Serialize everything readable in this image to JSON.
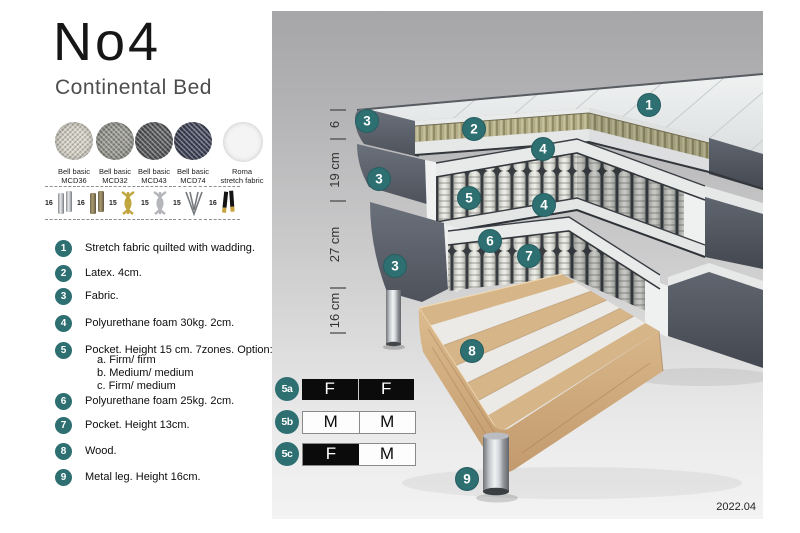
{
  "header": {
    "title": "No4",
    "subtitle": "Continental Bed"
  },
  "swatches": [
    {
      "line1": "Bell basic",
      "line2": "MCD36"
    },
    {
      "line1": "Bell basic",
      "line2": "MCD32"
    },
    {
      "line1": "Bell basic",
      "line2": "MCD43"
    },
    {
      "line1": "Bell basic",
      "line2": "MCD74"
    },
    {
      "line1": "Roma",
      "line2": "stretch fabric"
    }
  ],
  "leg_heights": [
    "16",
    "16",
    "15",
    "15",
    "15",
    "16"
  ],
  "legend": [
    {
      "num": "1",
      "text": "Stretch fabric quilted with wadding."
    },
    {
      "num": "2",
      "text": "Latex. 4cm."
    },
    {
      "num": "3",
      "text": "Fabric."
    },
    {
      "num": "4",
      "text": "Polyurethane foam 30kg. 2cm."
    },
    {
      "num": "5",
      "text": "Pocket. Height 15 cm. 7zones. Option:",
      "options": [
        "a. Firm/ firm",
        "b. Medium/ medium",
        "c. Firm/ medium"
      ]
    },
    {
      "num": "6",
      "text": "Polyurethane foam 25kg. 2cm."
    },
    {
      "num": "7",
      "text": "Pocket. Height 13cm."
    },
    {
      "num": "8",
      "text": "Wood."
    },
    {
      "num": "9",
      "text": "Metal leg. Height 16cm."
    }
  ],
  "diagram": {
    "dimensions": [
      "6",
      "19 cm",
      "27 cm",
      "16 cm"
    ],
    "callouts": [
      "1",
      "2",
      "3",
      "4",
      "5",
      "6",
      "7",
      "8",
      "9"
    ],
    "firmness": [
      {
        "label": "5a",
        "cells": [
          "F",
          "F"
        ]
      },
      {
        "label": "5b",
        "cells": [
          "M",
          "M"
        ]
      },
      {
        "label": "5c",
        "cells": [
          "F",
          "M"
        ]
      }
    ],
    "version": "2022.04"
  },
  "colors": {
    "accent_teal": "#2e6f72",
    "panel_top": "#a6a6a8",
    "panel_bottom": "#f3f3f3",
    "latex": "#b2ad87",
    "wood": "#d9ba8d",
    "fabric_dark": "#565c65"
  }
}
